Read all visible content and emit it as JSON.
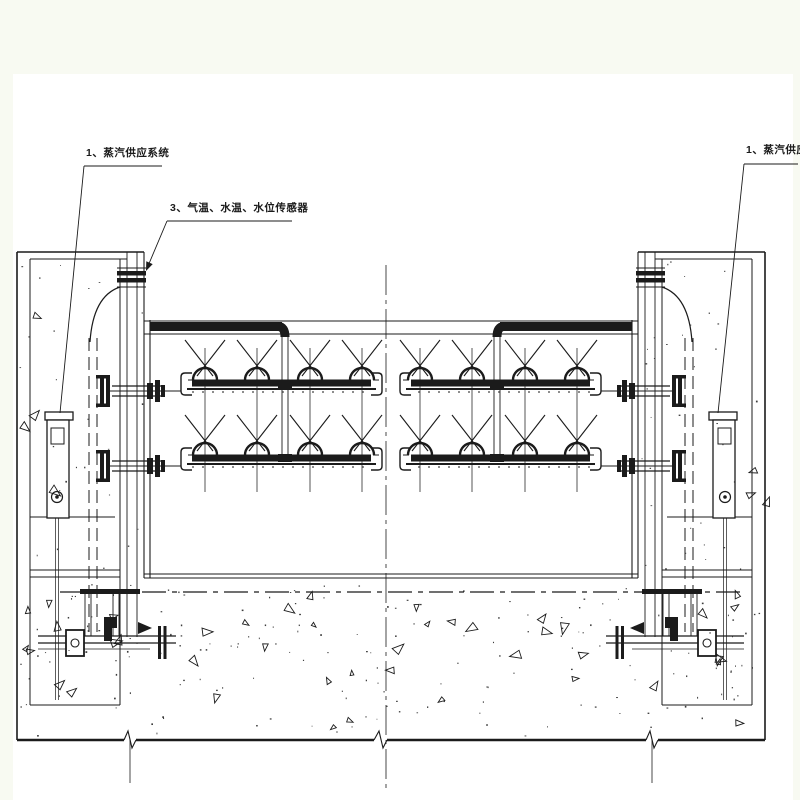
{
  "page": {
    "background": "#f8faf2",
    "paper": "#ffffff",
    "ink": "#1b1b1b"
  },
  "labels": {
    "steam_supply_left": "1、蒸汽供应系统",
    "sensors": "3、气温、水温、水位传感器",
    "steam_supply_right": "1、蒸汽供应系统"
  },
  "drawing": {
    "view": "section",
    "callout_numbers": [
      "1",
      "3",
      "1"
    ]
  }
}
